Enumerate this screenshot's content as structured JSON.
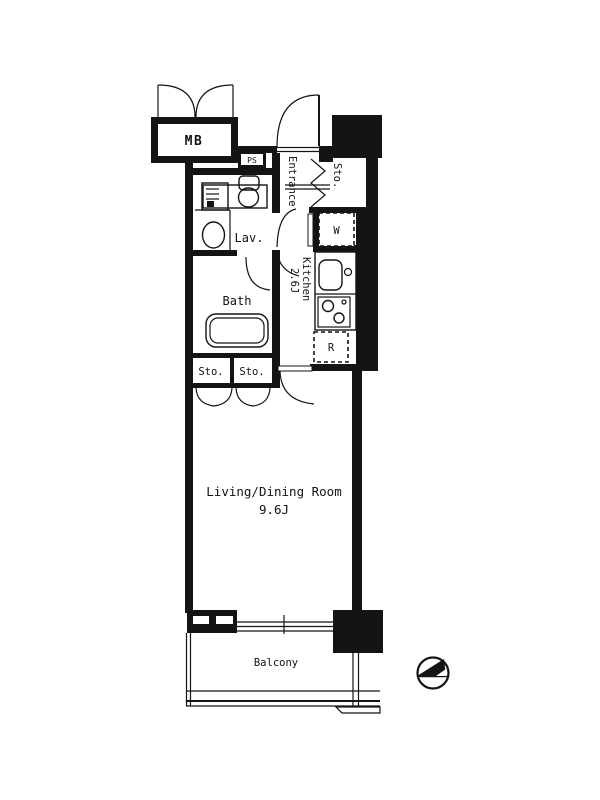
{
  "floor_plan": {
    "background_color": "#ffffff",
    "line_color": "#141414",
    "labels": {
      "meter_box": "MB",
      "pipe_shaft": "PS",
      "entrance": "Entrance",
      "entrance_storage": "Sto.",
      "washing_machine": "W",
      "lavatory": "Lav.",
      "kitchen_name": "Kitchen",
      "kitchen_size": "2.6J",
      "bath": "Bath",
      "hall_storage_left": "Sto.",
      "hall_storage_right": "Sto.",
      "refrigerator": "R",
      "living_dining_name": "Living/Dining Room",
      "living_dining_size": "9.6J",
      "balcony": "Balcony"
    },
    "icons": [
      "mb-door-swing-icon",
      "entrance-door-swing-icon",
      "bifold-door-icon",
      "washbasin-cabinet-icon",
      "toilet-icon",
      "wash-basin-icon",
      "bathtub-icon",
      "hall-door-swing-icon",
      "bath-door-swing-icon",
      "closet-double-door-icon",
      "kitchen-sink-icon",
      "gas-stove-icon",
      "ldk-door-swing-icon",
      "sliding-window-icon",
      "balcony-railing-icon",
      "north-compass-icon"
    ]
  }
}
